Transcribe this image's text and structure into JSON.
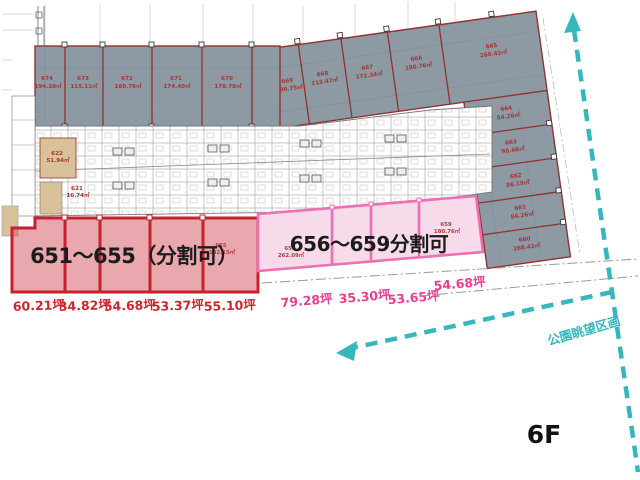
{
  "floor": {
    "label": "6F"
  },
  "park_view": {
    "label": "公園眺望区画"
  },
  "red_zone": {
    "title": "651～655（分割可）",
    "tsubo_labels": [
      "60.21坪",
      "34.82坪",
      "54.68坪",
      "53.37坪",
      "55.10坪"
    ],
    "unit_655": {
      "no": "655",
      "area": "182.15㎡"
    }
  },
  "pink_zone": {
    "title": "656～659分割可",
    "tsubo_labels": [
      "79.28坪",
      "35.30坪",
      "53.65坪",
      "54.68坪"
    ],
    "unit_656": {
      "no": "656",
      "area": "262.09㎡"
    },
    "unit_659": {
      "no": "659",
      "area": "180.76㎡"
    }
  },
  "gray_band_rooms": [
    {
      "no": "674",
      "area": "194.28㎡"
    },
    {
      "no": "673",
      "area": "115.11㎡"
    },
    {
      "no": "672",
      "area": "180.76㎡"
    },
    {
      "no": "671",
      "area": "174.40㎡"
    },
    {
      "no": "670",
      "area": "178.78㎡"
    },
    {
      "no": "669",
      "area": "190.75㎡"
    }
  ],
  "wing_rooms": [
    {
      "no": "668",
      "area": "113.47㎡"
    },
    {
      "no": "667",
      "area": "172.34㎡"
    },
    {
      "no": "666",
      "area": "180.76㎡"
    },
    {
      "no": "665",
      "area": "268.42㎡"
    },
    {
      "no": "664",
      "area": "84.26㎡"
    },
    {
      "no": "663",
      "area": "98.66㎡"
    },
    {
      "no": "662",
      "area": "86.19㎡"
    },
    {
      "no": "661",
      "area": "84.26㎡"
    },
    {
      "no": "660",
      "area": "268.42㎡"
    }
  ],
  "tan_rooms": [
    {
      "no": "622",
      "area": "51.94㎡"
    },
    {
      "no": "621",
      "area": "16.74㎡"
    }
  ],
  "colors": {
    "gray_fill": "#8d99a3",
    "red_accent": "#c8202e",
    "pink_accent": "#ee6fb2",
    "teal": "#35b7bd",
    "room_label": "#a83432"
  }
}
